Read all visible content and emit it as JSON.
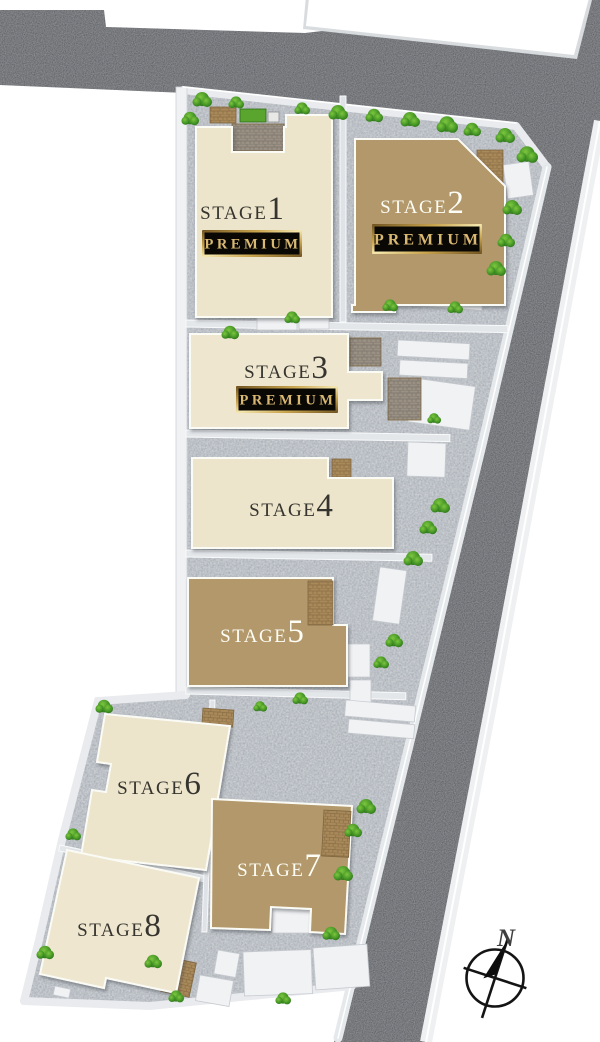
{
  "stages": [
    {
      "word": "STAGE",
      "num": "1",
      "premium": "PREMIUM",
      "label_color": "#35342e",
      "building_color": "#ece4cb"
    },
    {
      "word": "STAGE",
      "num": "2",
      "premium": "PREMIUM",
      "label_color": "#fdfdf5",
      "building_color": "#b2986a"
    },
    {
      "word": "STAGE",
      "num": "3",
      "premium": "PREMIUM",
      "label_color": "#35342e",
      "building_color": "#eee6cf"
    },
    {
      "word": "STAGE",
      "num": "4",
      "label_color": "#35342e",
      "building_color": "#ece4cb"
    },
    {
      "word": "STAGE",
      "num": "5",
      "label_color": "#fdfdf5",
      "building_color": "#b2986a"
    },
    {
      "word": "STAGE",
      "num": "6",
      "label_color": "#35342e",
      "building_color": "#ece4cb"
    },
    {
      "word": "STAGE",
      "num": "7",
      "label_color": "#fdfdf5",
      "building_color": "#b2986a"
    },
    {
      "word": "STAGE",
      "num": "8",
      "label_color": "#35342e",
      "building_color": "#eee6cf"
    }
  ],
  "badge": {
    "text_color": "#d8b872",
    "bg": "#0a0805"
  },
  "compass": {
    "north_label": "N"
  },
  "colors": {
    "road": "#4d5055",
    "ground": "#9ea5ad",
    "sidewalk": "#e9ebee",
    "pad": "#f1f2f4",
    "deck": "#a8895a",
    "deck_stone": "#9a9184",
    "green": "#3f8f23",
    "neighbor_block": "#ffffff"
  }
}
